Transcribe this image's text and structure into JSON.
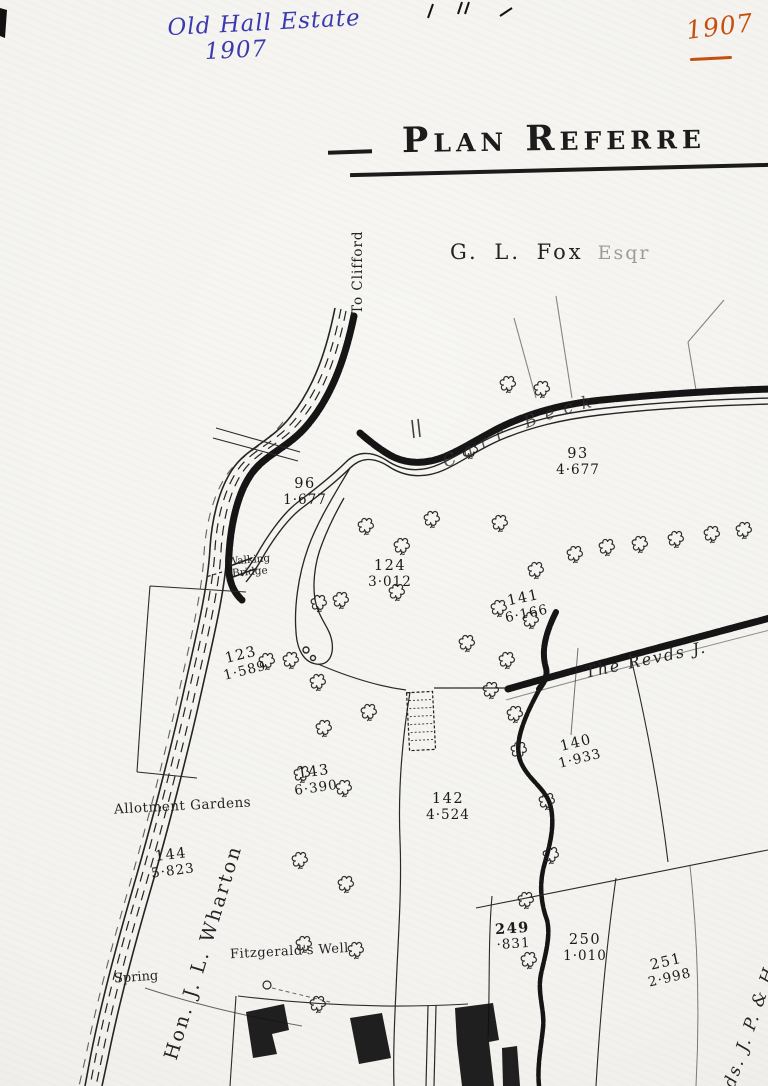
{
  "annotations": {
    "blue_line1": "Old Hall Estate",
    "blue_line2": "1907",
    "orange_year": "1907"
  },
  "header": {
    "title": "Plan Referre",
    "owner_name": "G. L. Fox",
    "owner_suffix": "Esqr"
  },
  "map": {
    "labels": {
      "to_clifford": "To Clifford",
      "carr_beck": "Carr Beck",
      "revds": "The Revds J.",
      "walking_bridge_line1": "Walking",
      "walking_bridge_line2": "Bridge",
      "allotment_gardens": "Allotment Gardens",
      "wharton": "Hon. J. L. Wharton",
      "spring": "Spring",
      "well": "Fitzgerald's Well.",
      "jp_owner": "ds. J. P. & H"
    },
    "parcels": [
      {
        "number": "96",
        "area": "1·677"
      },
      {
        "number": "93",
        "area": "4·677"
      },
      {
        "number": "124",
        "area": "3·012"
      },
      {
        "number": "141",
        "area": "6·166"
      },
      {
        "number": "123",
        "area": "1·589"
      },
      {
        "number": "140",
        "area": "1·933"
      },
      {
        "number": "143",
        "area": "6·390"
      },
      {
        "number": "142",
        "area": "4·524"
      },
      {
        "number": "144",
        "area": "5·823"
      },
      {
        "number": "249",
        "area": "·831"
      },
      {
        "number": "250",
        "area": "1·010"
      },
      {
        "number": "251",
        "area": "2·998"
      }
    ]
  },
  "colors": {
    "ink": "#1f1f1f",
    "blue_ink": "#3a3aae",
    "orange_ink": "#c4500e",
    "paper": "#f5f4f1"
  }
}
